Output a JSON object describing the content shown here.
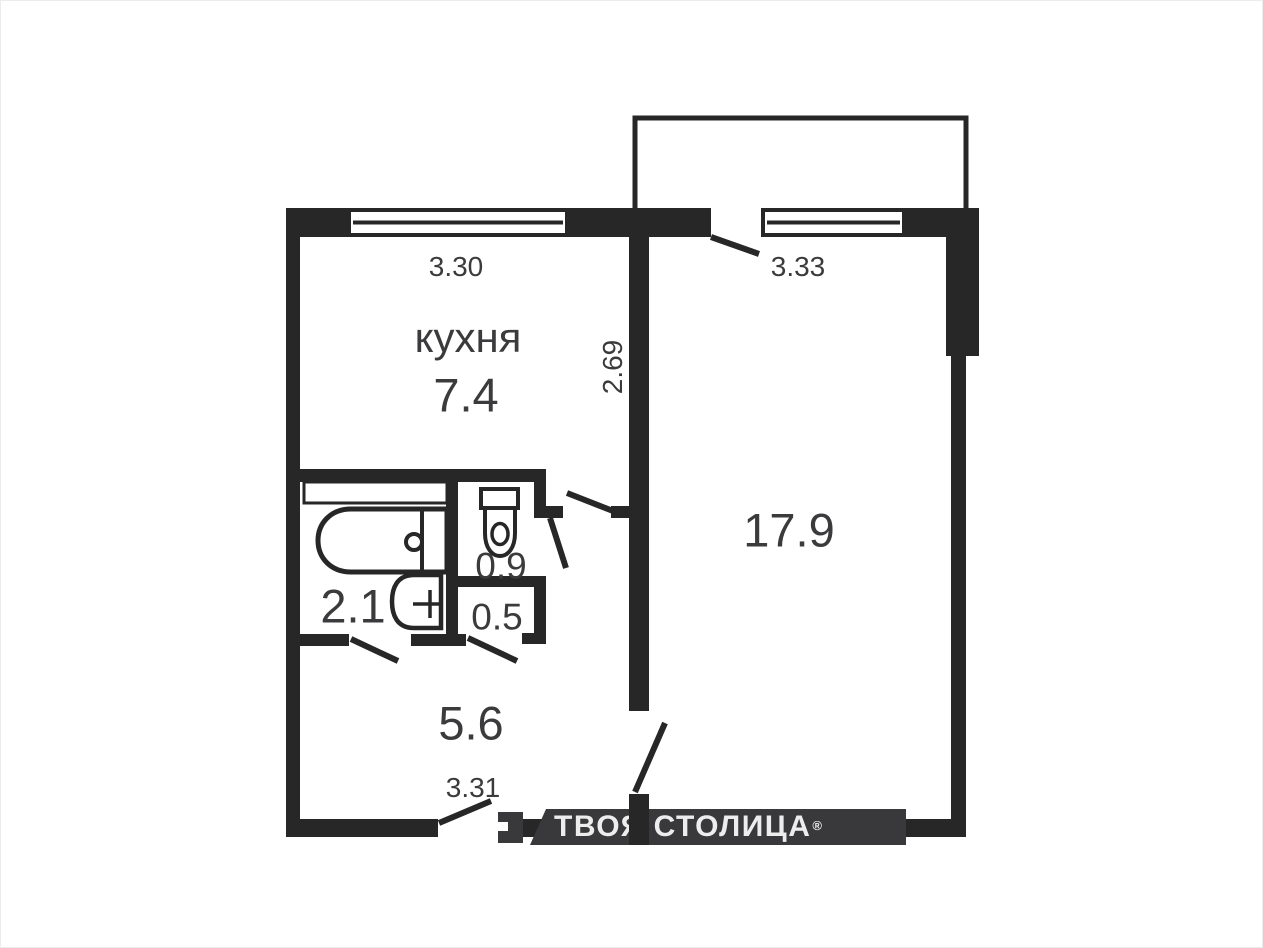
{
  "rooms": {
    "kitchen": {
      "name": "кухня",
      "area": "7.4"
    },
    "living": {
      "area": "17.9"
    },
    "bath": {
      "area": "2.1"
    },
    "wc": {
      "area": "0.9"
    },
    "storage": {
      "area": "0.5"
    },
    "hall": {
      "area": "5.6"
    }
  },
  "dims": {
    "kitchen_width": "3.30",
    "living_width": "3.33",
    "kitchen_depth": "2.69",
    "hall_width": "3.31"
  },
  "watermark": {
    "text": "ТВОЯ СТОЛИЦА",
    "reg": "®"
  },
  "colors": {
    "wall": "#272727",
    "background": "#ffffff",
    "label_text": "#3b3b3d",
    "watermark_bar": "#39393b",
    "watermark_text": "#ededed"
  }
}
